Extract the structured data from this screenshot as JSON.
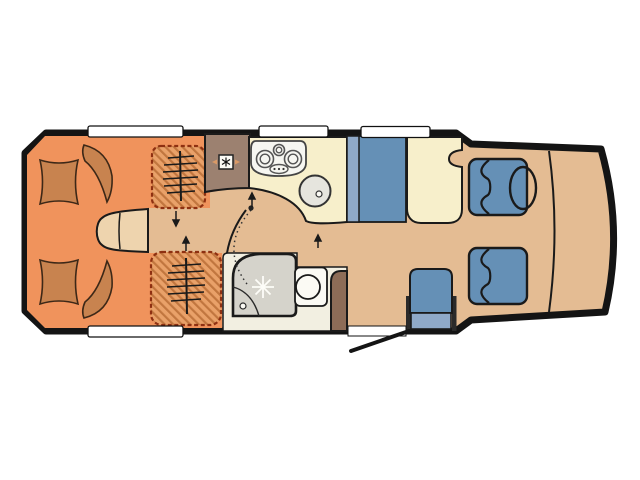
{
  "floorplan": {
    "type": "motorhome-floor-plan",
    "rear_bed": {
      "cushions": 4,
      "wardrobes": 2
    },
    "kitchen": {
      "hob_burners": 3,
      "sink": true,
      "fridge": true
    },
    "dinette": {
      "bench": true,
      "table": true
    },
    "bathroom": {
      "shower": true,
      "toilet": true,
      "cabinet": true
    },
    "cab": {
      "seats": 2,
      "steering_wheel": true
    },
    "travel_seat": true,
    "entry_door": true,
    "windows_top": 3,
    "windows_bottom": 1
  },
  "icons": {
    "fridge": "snowflake-in-box",
    "shower_head": "star-burst",
    "wardrobe_rail": "hanger-rail",
    "direction_arrows": "up-down-arrows"
  },
  "colors": {
    "background": "#ffffff",
    "wall": "#141414",
    "floor": "#e4bc93",
    "floor_light": "#eed4ae",
    "bed": "#f0935c",
    "cushion": "#c8834f",
    "wardrobe_bg": "#e9a169",
    "wardrobe_stripe": "#c1763f",
    "wardrobe_border": "#8e3011",
    "cabinet": "#9c8170",
    "cabinet_dark": "#8d6c57",
    "cream": "#f7efcb",
    "seat_blue": "#6590b6",
    "seat_blue_light": "#8fa9c8",
    "bath_floor": "#f2efe1",
    "shower": "#d5d3cb",
    "appliance": "#f6f6f1",
    "sink_gray": "#e6e5de",
    "white_fixture": "#fbfaf4",
    "window": "#ffffff"
  }
}
